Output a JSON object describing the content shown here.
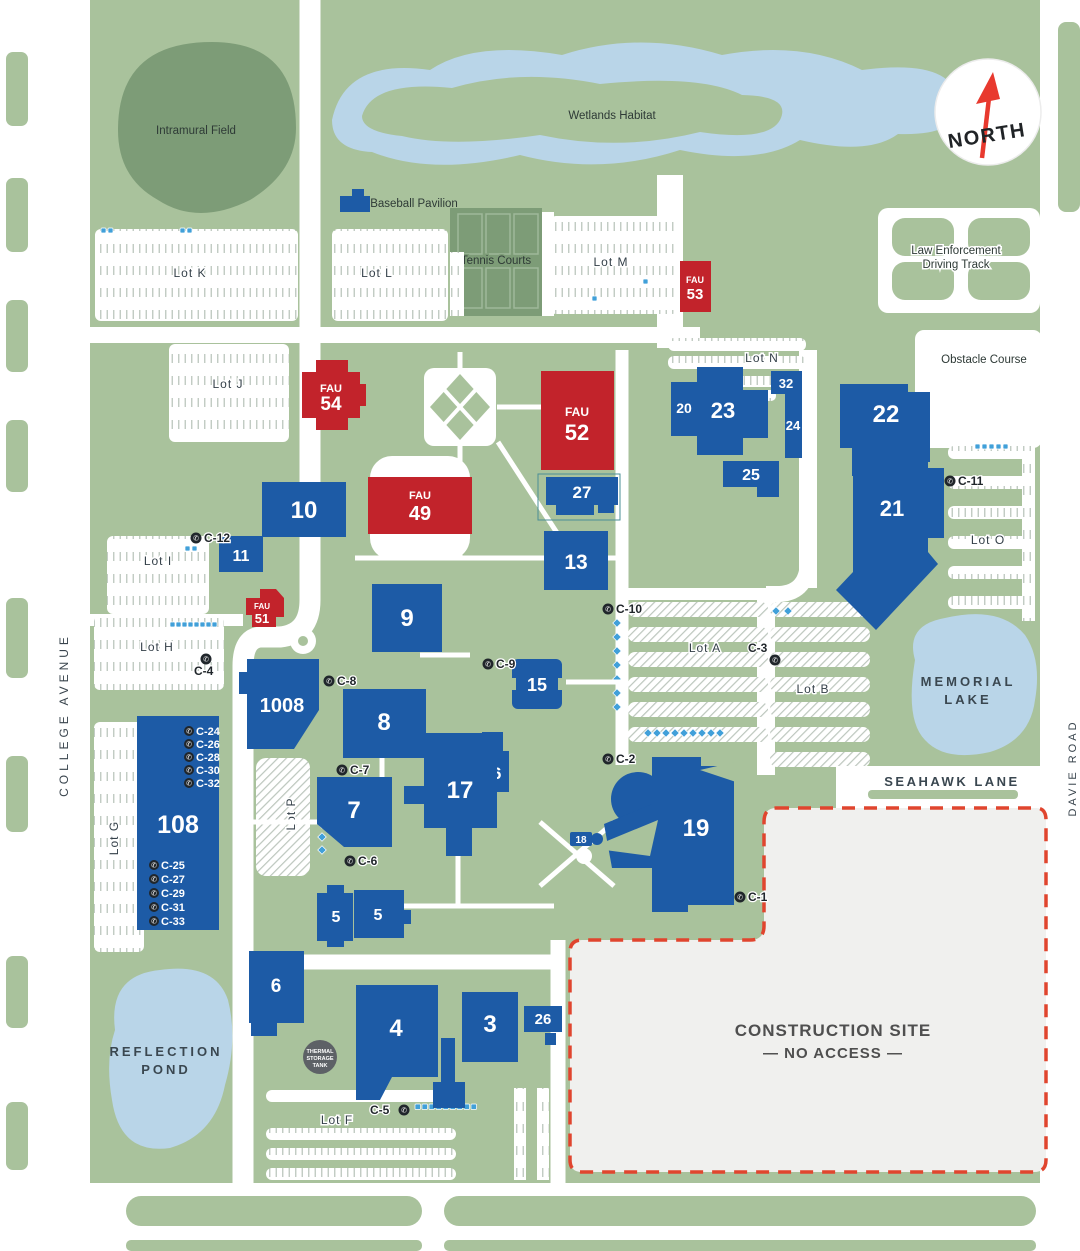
{
  "compass": {
    "label": "NORTH"
  },
  "streets": {
    "college_avenue": "COLLEGE AVENUE",
    "seahawk_lane": "SEAHAWK LANE",
    "davie_road": "DAVIE ROAD"
  },
  "places": {
    "intramural_field": "Intramural Field",
    "wetlands_habitat": "Wetlands Habitat",
    "baseball_pavilion": "Baseball Pavilion",
    "tennis_courts": "Tennis Courts",
    "law_enforcement_line1": "Law Enforcement",
    "law_enforcement_line2": "Driving Track",
    "obstacle_course": "Obstacle Course",
    "memorial_lake_line1": "MEMORIAL",
    "memorial_lake_line2": "LAKE",
    "reflection_pond_line1": "REFLECTION",
    "reflection_pond_line2": "POND",
    "thermal_tank_line1": "THERMAL",
    "thermal_tank_line2": "STORAGE",
    "thermal_tank_line3": "TANK"
  },
  "construction": {
    "line1": "CONSTRUCTION SITE",
    "line2": "—  NO ACCESS  —"
  },
  "lots": {
    "a": "Lot A",
    "b": "Lot B",
    "f": "Lot F",
    "g": "Lot G",
    "h": "Lot H",
    "i": "Lot I",
    "j": "Lot J",
    "k": "Lot K",
    "l": "Lot L",
    "m": "Lot M",
    "n": "Lot N",
    "o": "Lot O",
    "p": "Lot P"
  },
  "buildings": {
    "b3": "3",
    "b4": "4",
    "b5_west": "5",
    "b5_east": "5",
    "b6": "6",
    "b7": "7",
    "b8": "8",
    "b9": "9",
    "b10": "10",
    "b11": "11",
    "b13": "13",
    "b15": "15",
    "b16": "16",
    "b17": "17",
    "b18": "18",
    "b19": "19",
    "b20": "20",
    "b21": "21",
    "b22": "22",
    "b23": "23",
    "b24": "24",
    "b25": "25",
    "b26": "26",
    "b27": "27",
    "b32": "32",
    "b108": "108",
    "b1008": "1008"
  },
  "fau": {
    "prefix": "FAU",
    "f49": "49",
    "f51": "51",
    "f52": "52",
    "f53": "53",
    "f54": "54"
  },
  "callboxes": {
    "c1": "C-1",
    "c2": "C-2",
    "c3": "C-3",
    "c4": "C-4",
    "c5": "C-5",
    "c6": "C-6",
    "c7": "C-7",
    "c8": "C-8",
    "c9": "C-9",
    "c10": "C-10",
    "c11": "C-11",
    "c12": "C-12",
    "c24": "C-24",
    "c25": "C-25",
    "c26": "C-26",
    "c27": "C-27",
    "c28": "C-28",
    "c29": "C-29",
    "c30": "C-30",
    "c31": "C-31",
    "c32": "C-32",
    "c33": "C-33"
  },
  "icons": {
    "north_arrow": "up-arrow",
    "callbox_phone": "✆",
    "accessible_parking": "wheelchair-square"
  },
  "colors": {
    "building_blue": "#1d5ba6",
    "fau_red": "#c2232b",
    "land_green": "#a9c29c",
    "field_green": "#7d9c77",
    "water_blue": "#b9d5e8",
    "construction_fill": "#f0f0ee",
    "construction_border": "#e0452e",
    "accessible_blue": "#41a0d9",
    "callbox_dark": "#20262b"
  }
}
